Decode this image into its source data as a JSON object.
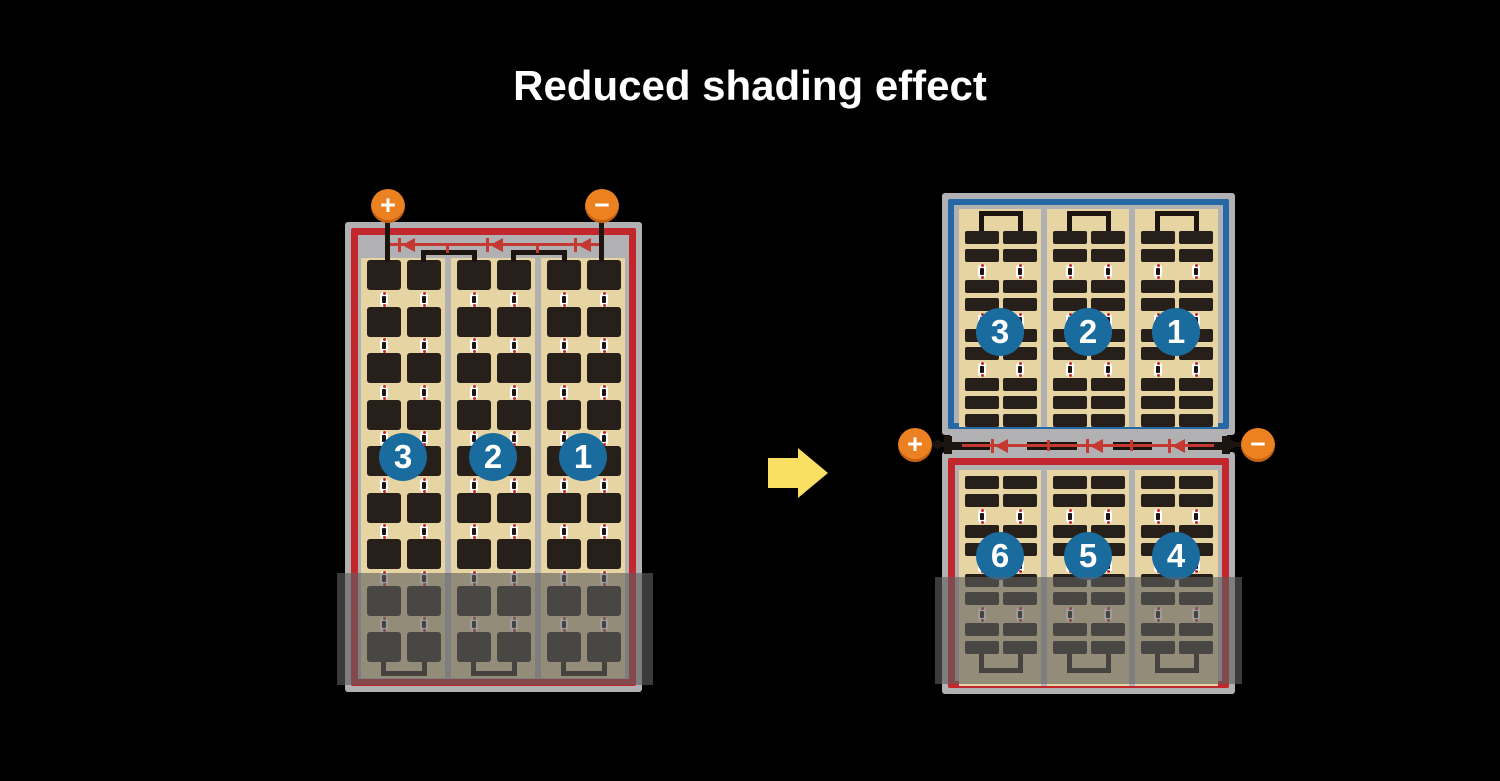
{
  "title": "Reduced shading effect",
  "left_module": {
    "name": "full-string module with shading",
    "terminals": {
      "positive": "+",
      "negative": "−"
    },
    "cell_strings": [
      {
        "number": "3"
      },
      {
        "number": "2"
      },
      {
        "number": "1"
      }
    ]
  },
  "right_module": {
    "name": "half-cut twin module with shading",
    "terminals": {
      "positive": "+",
      "negative": "−"
    },
    "top_half_strings": [
      {
        "number": "3"
      },
      {
        "number": "2"
      },
      {
        "number": "1"
      }
    ],
    "bottom_half_strings": [
      {
        "number": "6"
      },
      {
        "number": "5"
      },
      {
        "number": "4"
      }
    ]
  },
  "colors": {
    "background": "#000000",
    "title_text": "#ffffff",
    "module_frame": "#b1b1b3",
    "string_border_red": "#c1272d",
    "string_border_blue": "#2667a5",
    "cell_sheet": "#e6d5a3",
    "cell_dark": "#27201a",
    "wire_black": "#1c140e",
    "diode_red": "#c63832",
    "dot_red": "#cc2424",
    "number_badge_blue": "#1a6b9e",
    "terminal_orange": "#ec8122",
    "arrow_yellow": "#f9df63",
    "shade_overlay": "rgba(96,96,96,0.62)"
  }
}
